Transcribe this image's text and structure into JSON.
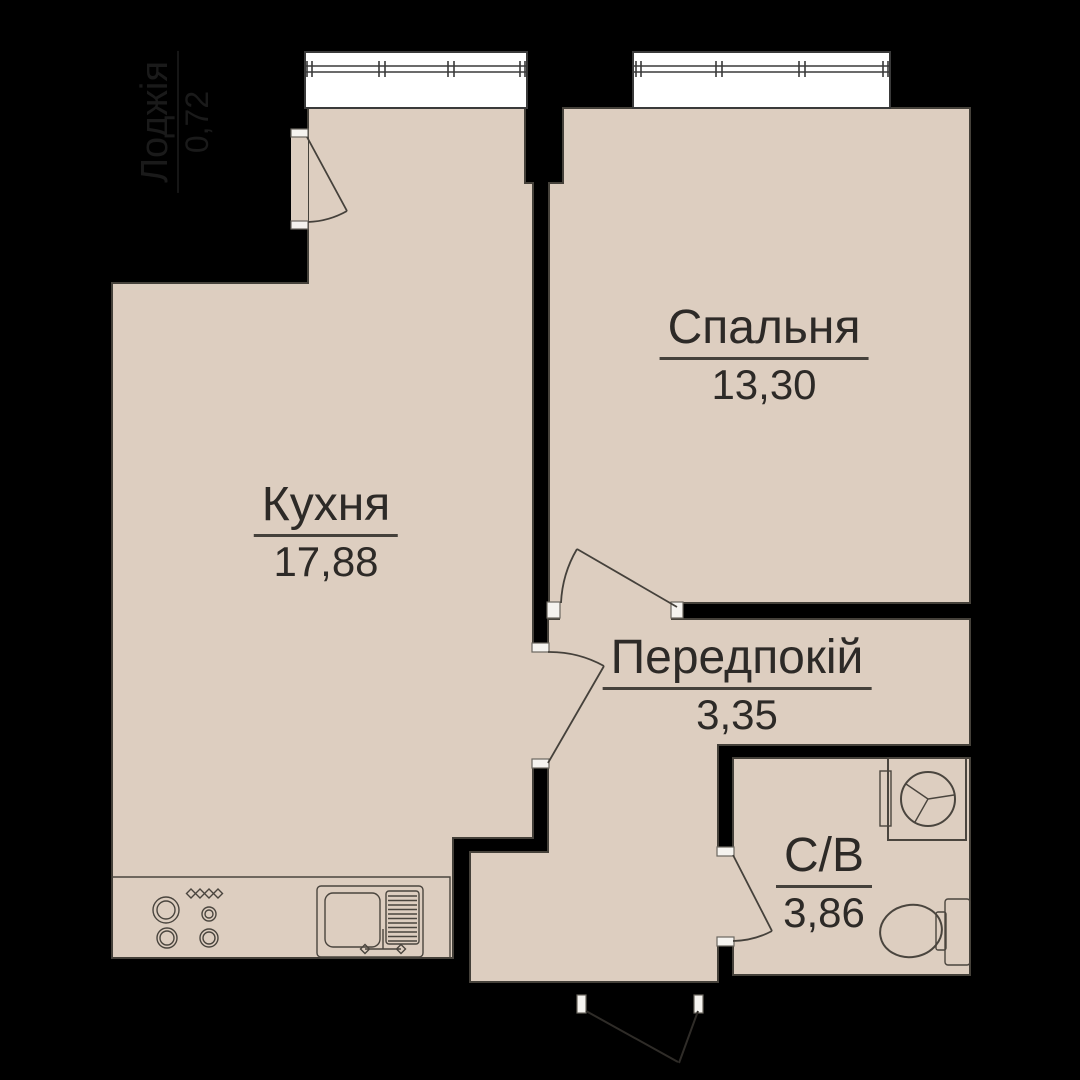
{
  "plan": {
    "title": "Apartment floor plan",
    "rooms": [
      {
        "id": "kitchen",
        "name": "Кухня",
        "area": "17,88"
      },
      {
        "id": "bedroom",
        "name": "Спальня",
        "area": "13,30"
      },
      {
        "id": "hallway",
        "name": "Передпокій",
        "area": "3,35"
      },
      {
        "id": "bathroom",
        "name": "С/В",
        "area": "3,86"
      },
      {
        "id": "loggia",
        "name": "Лоджія",
        "area": "0,72"
      }
    ],
    "fixtures": [
      "stove-icon",
      "kitchen-sink-icon",
      "washing-machine-icon",
      "toilet-icon"
    ],
    "colors": {
      "background": "#000000",
      "floor": "#ddcec0",
      "window": "#ffffff",
      "outline": "#45413a",
      "label_text": "#2d2a27",
      "loggia_text": "#1a1a1a"
    }
  }
}
